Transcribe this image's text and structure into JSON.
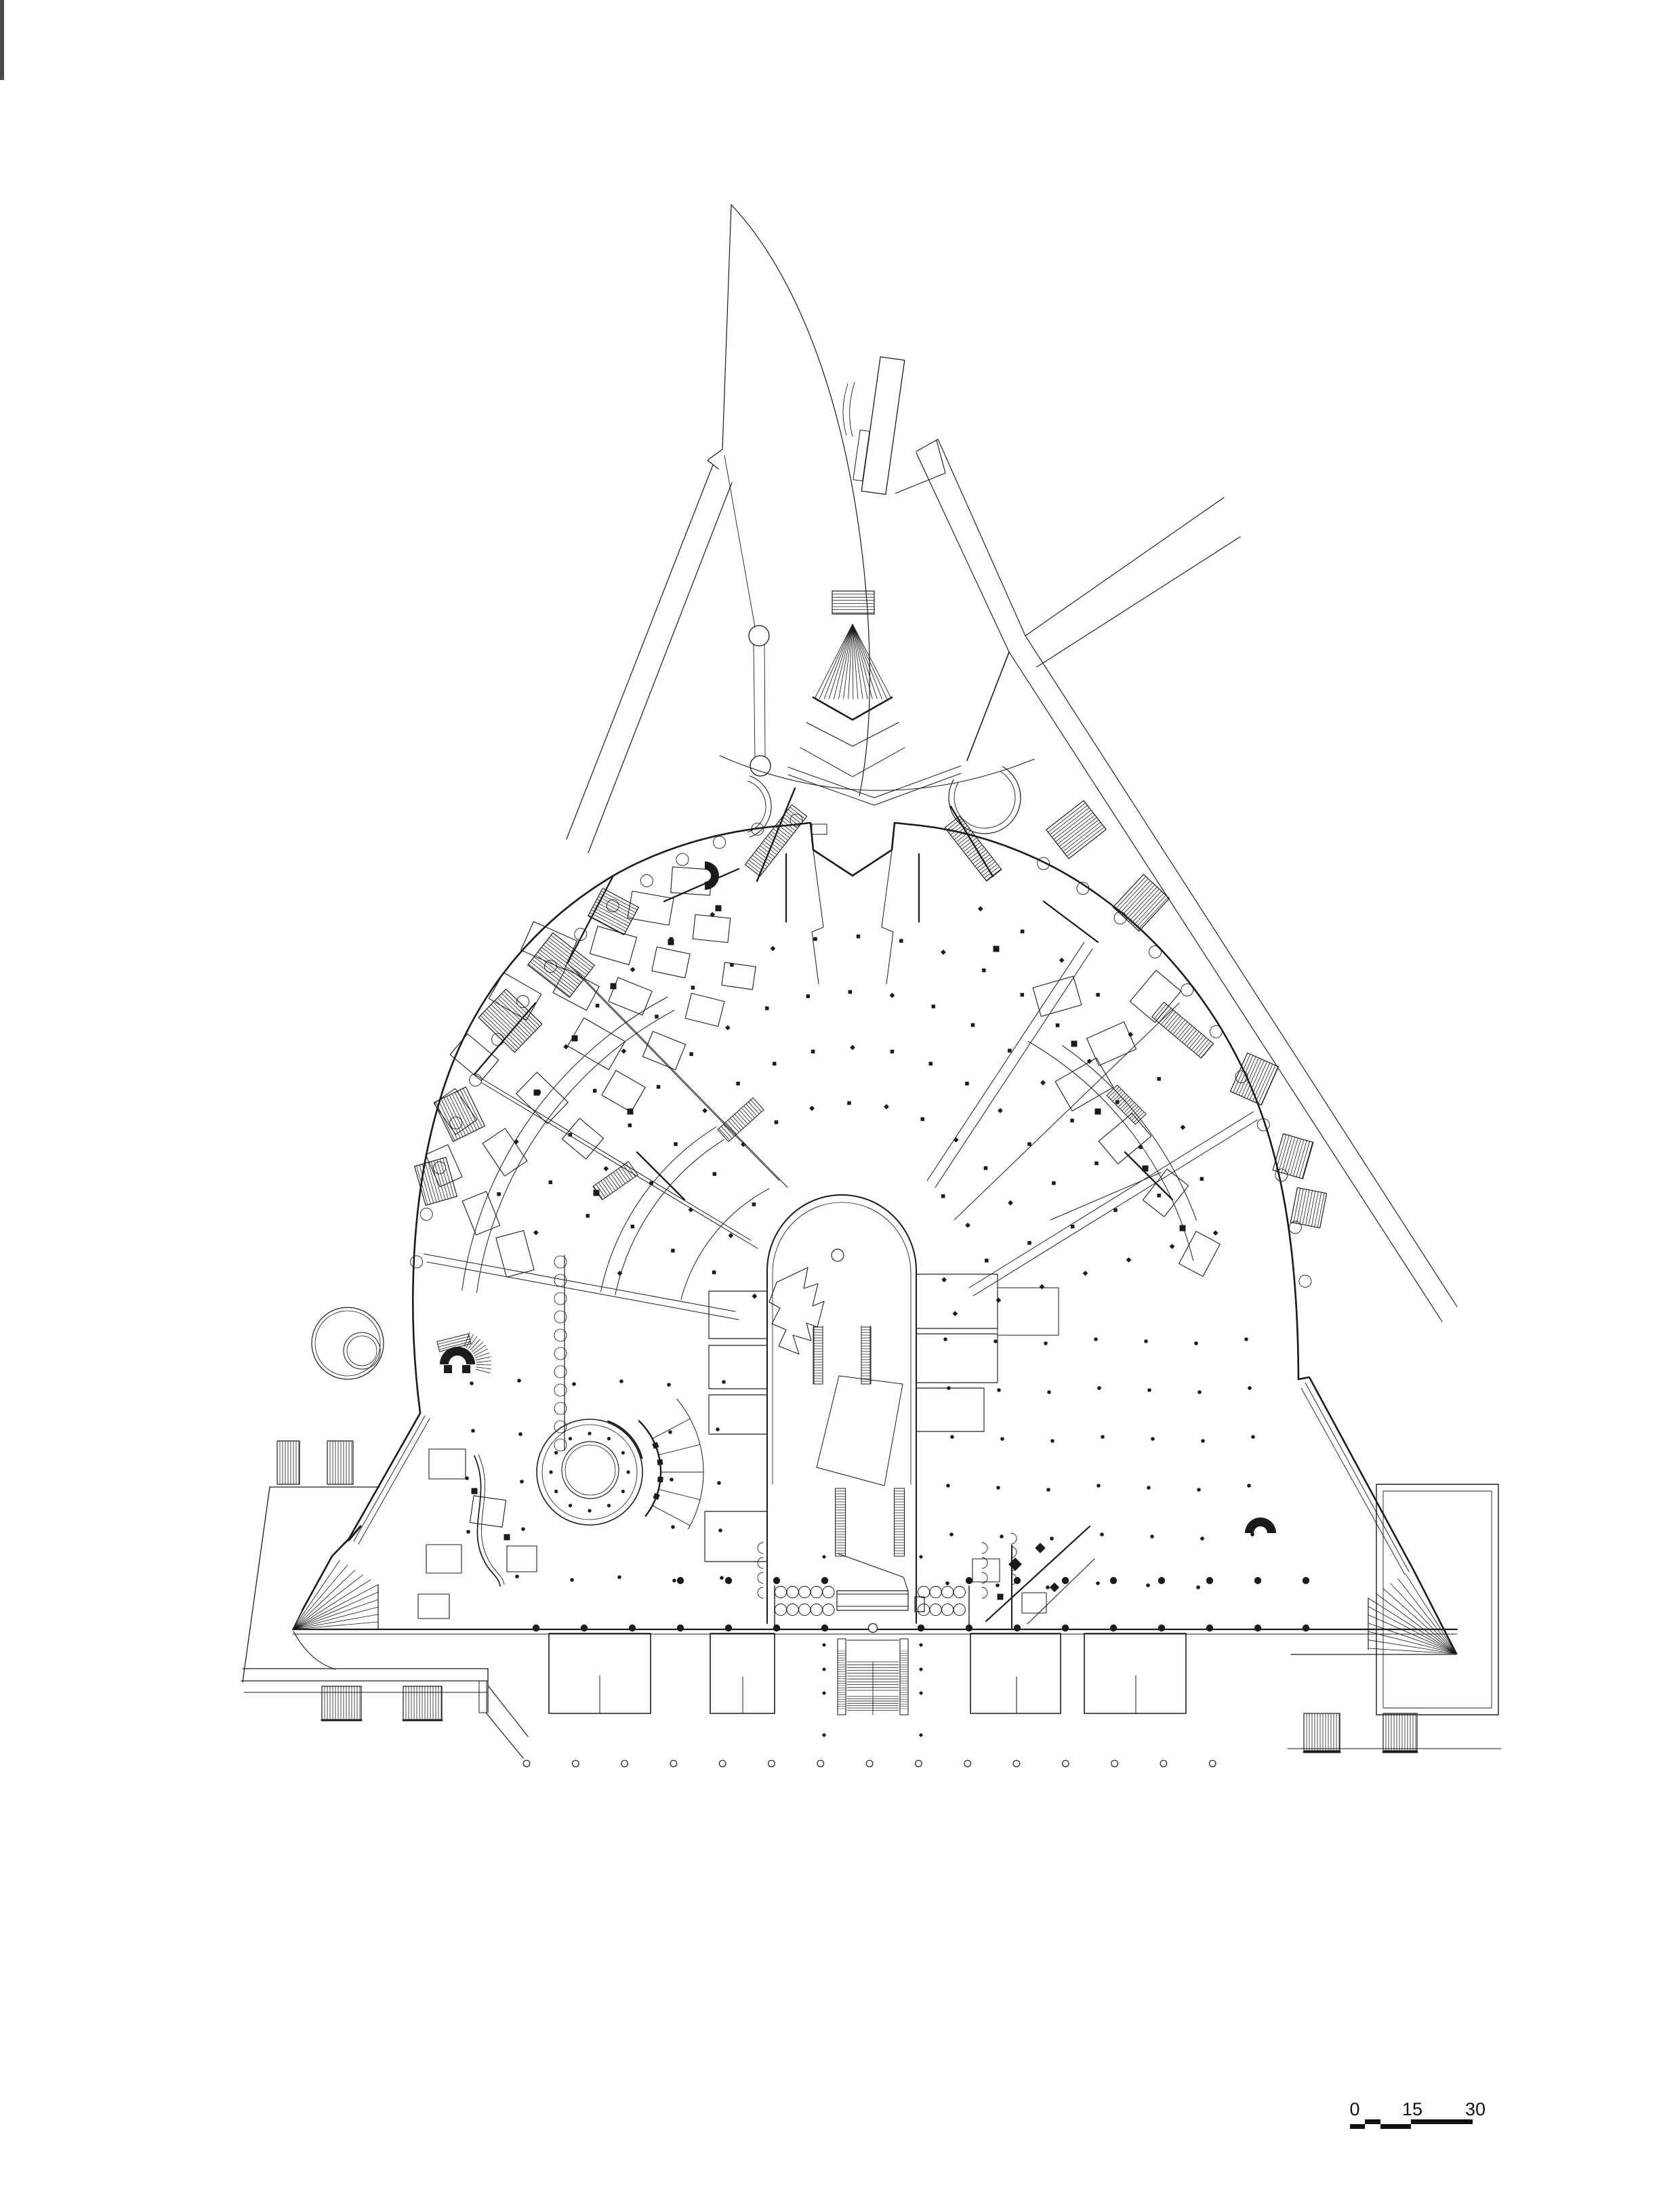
{
  "document": {
    "kind": "architectural-floor-plan",
    "visible_text_only": [
      "0",
      "15",
      "30"
    ]
  },
  "scale_bar": {
    "t0": "0",
    "t15": "15",
    "t30": "30"
  },
  "colors": {
    "ink": "#1b1b1b",
    "paper": "#ffffff",
    "scan_artifact": "#4a4a4a"
  }
}
